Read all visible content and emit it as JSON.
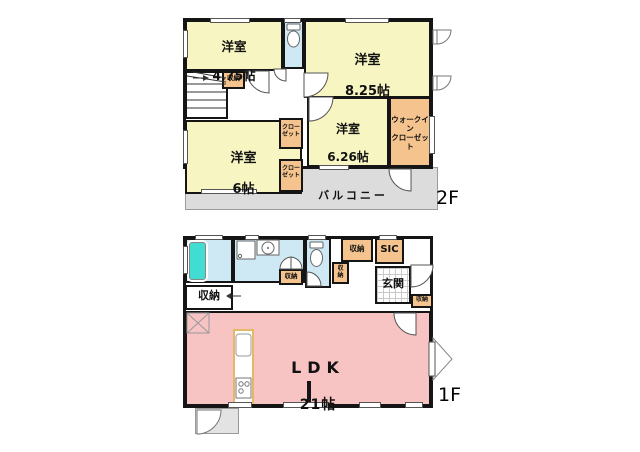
{
  "plan": {
    "floor2": {
      "floor_label": "2F",
      "rooms": {
        "bedroom_475": {
          "name": "洋室",
          "size": "4.75帖"
        },
        "bedroom_825": {
          "name": "洋室",
          "size": "8.25帖"
        },
        "bedroom_626": {
          "name": "洋室",
          "size": "6.26帖"
        },
        "bedroom_6": {
          "name": "洋室",
          "size": "6帖"
        },
        "walkin_closet": {
          "name": "ウォークイン\nクローゼット"
        },
        "closet": {
          "name": "クロー\nゼット"
        },
        "storage": {
          "name": "収納"
        },
        "balcony": {
          "name": "バルコニー"
        }
      }
    },
    "floor1": {
      "floor_label": "1F",
      "rooms": {
        "ldk": {
          "name": "LDK",
          "size": "21帖"
        },
        "entrance": {
          "name": "玄関"
        },
        "shoe_closet": {
          "name": "SIC"
        },
        "storage": {
          "name": "収納"
        },
        "storage_vertical": {
          "name": "収\n納"
        }
      }
    }
  },
  "colors": {
    "wall": "#151515",
    "bedroom_fill": "#f7f5c1",
    "closet_fill": "#f5c48e",
    "water_fill": "#cfe9f4",
    "bathtub_fill": "#42ddd2",
    "ldk_fill": "#f8c3c3",
    "balcony_fill": "#dcdcdc",
    "entrance_tile_line": "#c9c9c9",
    "kitchen_counter": "#e3b966"
  }
}
